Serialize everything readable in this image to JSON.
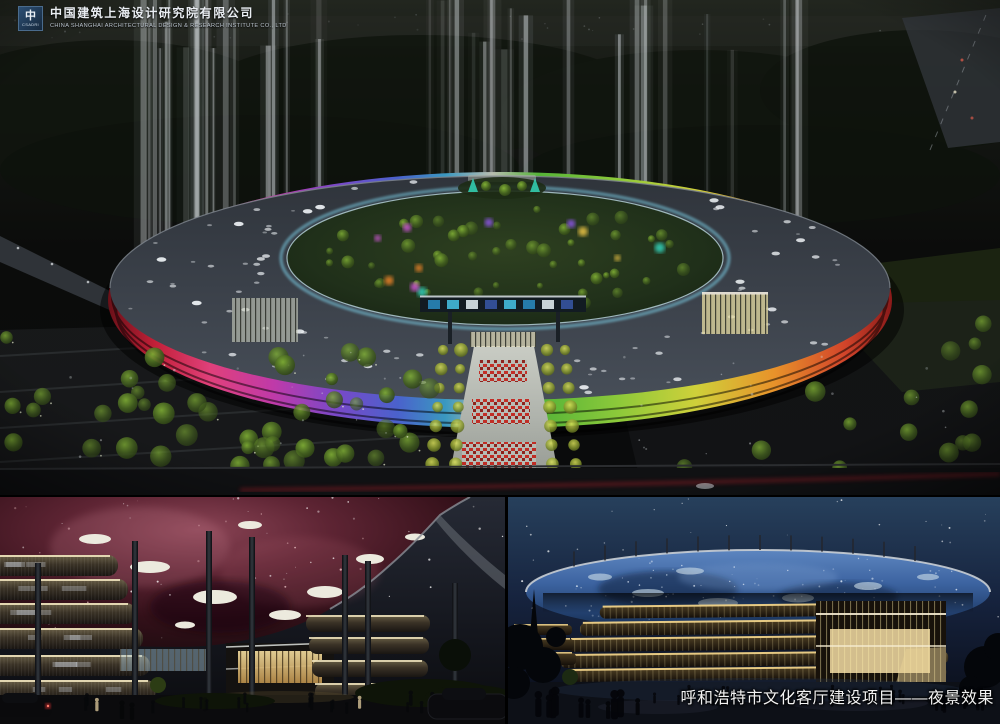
{
  "window": {
    "width": 1000,
    "height": 724
  },
  "header": {
    "logo_icon": "cscec-logo-icon",
    "logo_glyph": "中",
    "logo_subtext": "CSADRI",
    "company_name_zh": "中国建筑上海设计研究院有限公司",
    "company_name_en": "CHINA SHANGHAI ARCHITECTURAL DESIGN & RESEARCH INSTITUTE CO., LTD"
  },
  "caption": {
    "text": "呼和浩特市文化客厅建设项目——夜景效果"
  },
  "panels": {
    "main": {
      "name": "aerial-night-render"
    },
    "bottom_left": {
      "name": "nebula-canopy-render"
    },
    "bottom_right": {
      "name": "starlight-canopy-render"
    }
  },
  "colors": {
    "background": "#000000",
    "sky_navy": "#1e3054",
    "nebula_red": "#6a2436",
    "canopy_blue": "#3c63a0",
    "facade_gold": "#e8c878",
    "facade_magenta": "#d8409a",
    "facade_green": "#6ec832",
    "carpet_red": "#c8201a",
    "beam_white": "#dfe5ea",
    "text_white": "#f2f2f2"
  }
}
